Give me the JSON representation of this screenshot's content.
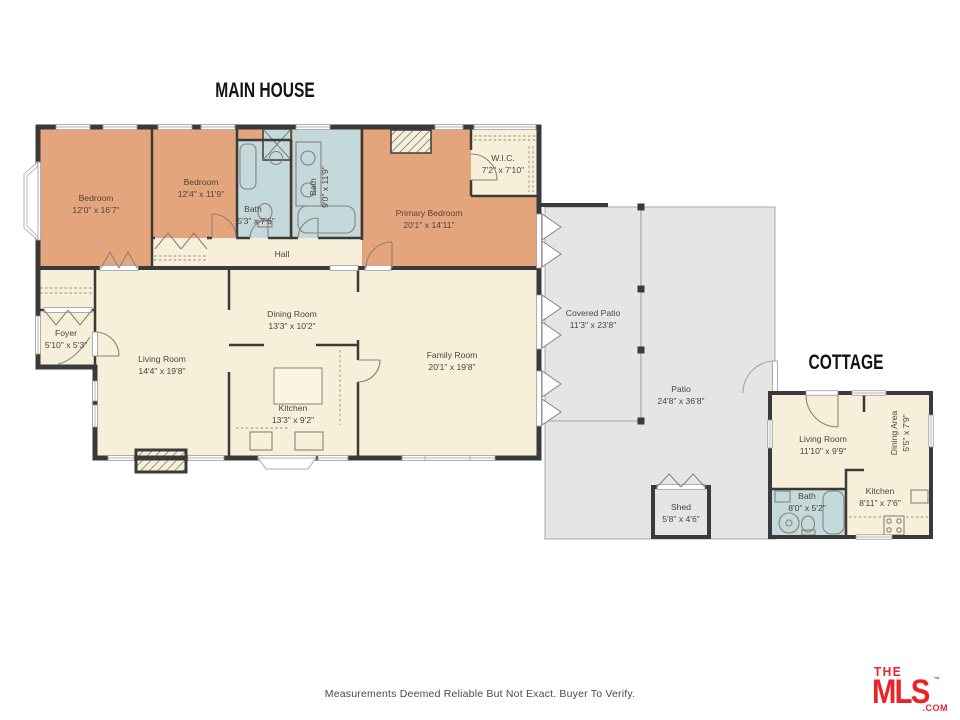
{
  "titles": {
    "main_house": "MAIN HOUSE",
    "cottage": "COTTAGE"
  },
  "rooms": {
    "main": {
      "bedroom1": {
        "name": "Bedroom",
        "dims": "12'0\" x 16'7\""
      },
      "bedroom2": {
        "name": "Bedroom",
        "dims": "12'4\" x 11'9\""
      },
      "bath_hall": {
        "name": "Bath",
        "dims": "5'3\" x 7'6\""
      },
      "bath_main": {
        "name": "Bath",
        "dims": "9'0\" x 11'9\""
      },
      "primary": {
        "name": "Primary Bedroom",
        "dims": "20'1\" x 14'11\""
      },
      "wic": {
        "name": "W.I.C.",
        "dims": "7'2\" x 7'10\""
      },
      "hall": {
        "name": "Hall"
      },
      "foyer": {
        "name": "Foyer",
        "dims": "5'10\" x 5'3\""
      },
      "living": {
        "name": "Living Room",
        "dims": "14'4\" x 19'8\""
      },
      "dining": {
        "name": "Dining Room",
        "dims": "13'3\" x 10'2\""
      },
      "kitchen": {
        "name": "Kitchen",
        "dims": "13'3\" x 9'2\""
      },
      "family": {
        "name": "Family Room",
        "dims": "20'1\" x 19'8\""
      }
    },
    "outdoor": {
      "covered_patio": {
        "name": "Covered Patio",
        "dims": "11'3\" x 23'8\""
      },
      "patio": {
        "name": "Patio",
        "dims": "24'8\" x 36'8\""
      },
      "shed": {
        "name": "Shed",
        "dims": "5'8\" x 4'6\""
      }
    },
    "cottage": {
      "living": {
        "name": "Living Room",
        "dims": "11'10\" x 9'9\""
      },
      "dining": {
        "name": "Dining Area",
        "dims": "5'5\" x 7'9\""
      },
      "kitchen": {
        "name": "Kitchen",
        "dims": "8'11\" x 7'6\""
      },
      "bath": {
        "name": "Bath",
        "dims": "8'0\" x 5'2\""
      }
    }
  },
  "footer": {
    "disclaimer": "Measurements Deemed Reliable But Not Exact. Buyer To Verify."
  },
  "logo": {
    "line1": "THE",
    "line2": "MLS",
    "suffix": ".COM",
    "tm": "™"
  },
  "colors": {
    "bedroom": "#E5A57C",
    "bath": "#C3D9DB",
    "living": "#F6F0DB",
    "patio": "#E5E5E6",
    "wall": "#3A3A3A",
    "logo_red": "#EC2227"
  }
}
